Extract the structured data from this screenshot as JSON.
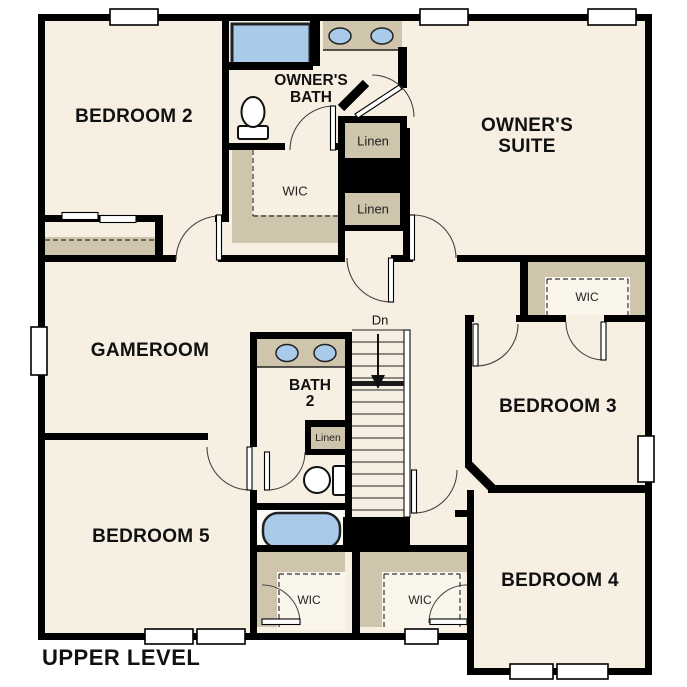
{
  "plan": {
    "title": "UPPER LEVEL",
    "rooms": {
      "bedroom2": "BEDROOM 2",
      "bedroom3": "BEDROOM 3",
      "bedroom4": "BEDROOM 4",
      "bedroom5": "BEDROOM 5",
      "gameroom": "GAMEROOM",
      "owners_suite_line1": "OWNER'S",
      "owners_suite_line2": "SUITE",
      "owners_bath_line1": "OWNER'S",
      "owners_bath_line2": "BATH",
      "bath2_line1": "BATH",
      "bath2_line2": "2"
    },
    "closets": {
      "owners_wic": "WIC",
      "bedroom3_wic": "WIC",
      "bedroom5_wic": "WIC",
      "bedroom4_wic": "WIC",
      "linen_upper": "Linen",
      "linen_lower": "Linen",
      "bath2_linen": "Linen"
    },
    "stairs": {
      "direction_label": "Dn"
    },
    "colors": {
      "floor": "#f6efe2",
      "shelf": "#cfc5ad",
      "fixture": "#a9cbe9",
      "wall": "#000000",
      "background": "#ffffff"
    }
  }
}
